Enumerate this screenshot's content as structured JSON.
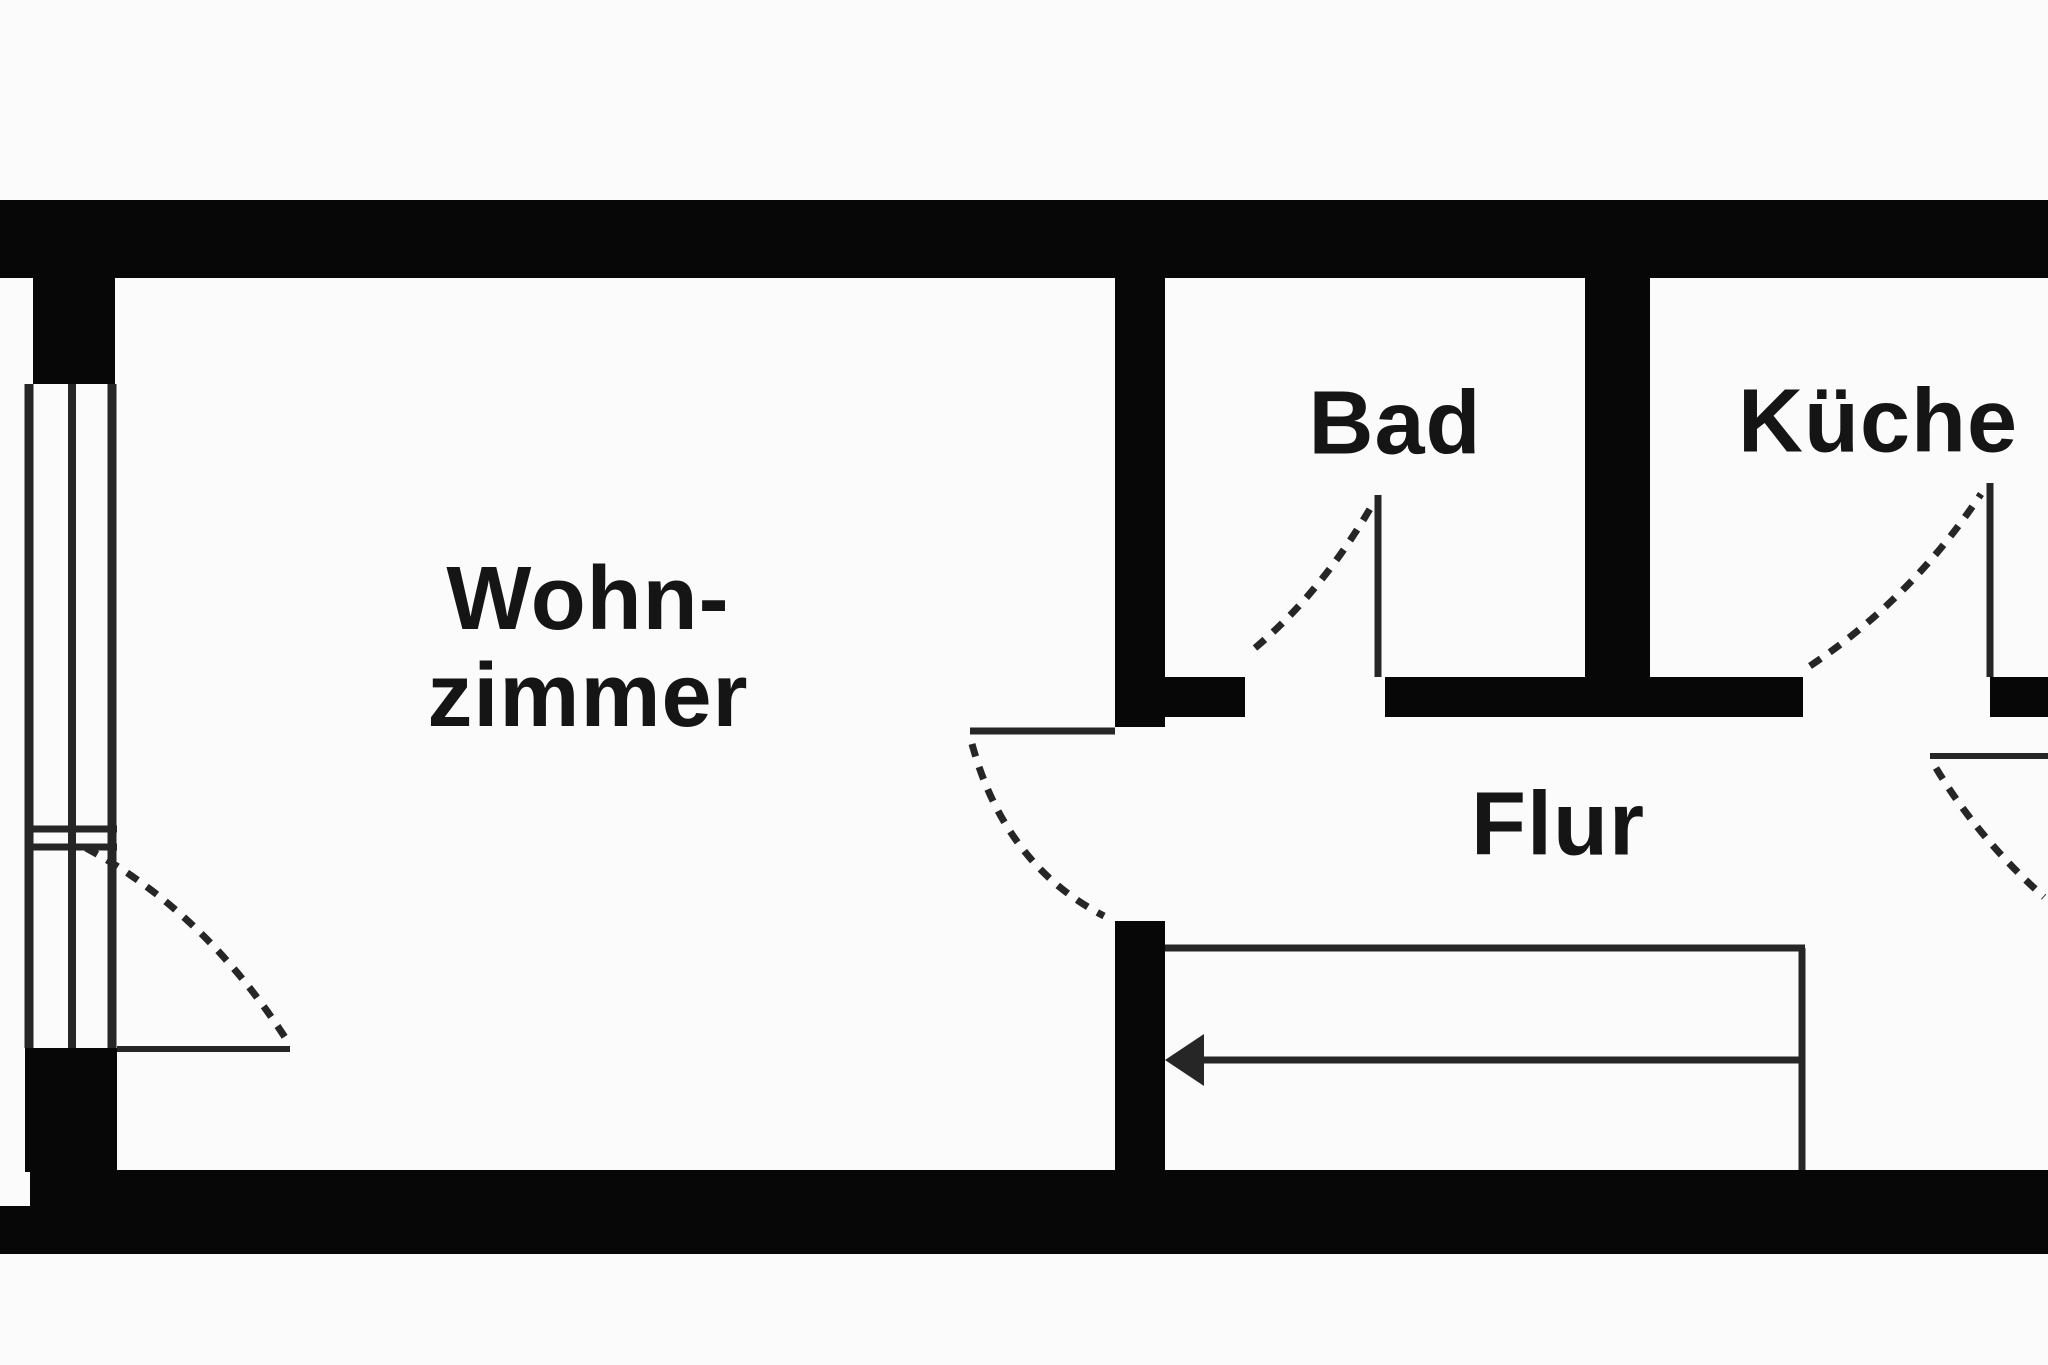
{
  "document": {
    "type": "floor-plan",
    "language": "de"
  },
  "rooms": {
    "wohnzimmer": {
      "label_line1": "Wohn-",
      "label_line2": "zimmer"
    },
    "bad": {
      "label": "Bad"
    },
    "kueche": {
      "label": "Küche"
    },
    "flur": {
      "label": "Flur"
    }
  },
  "stairs": {
    "arrow_direction": "left"
  },
  "colors": {
    "wall": "#070707",
    "line": "#262626",
    "bg": "#fbfbfb",
    "text": "#151515"
  }
}
